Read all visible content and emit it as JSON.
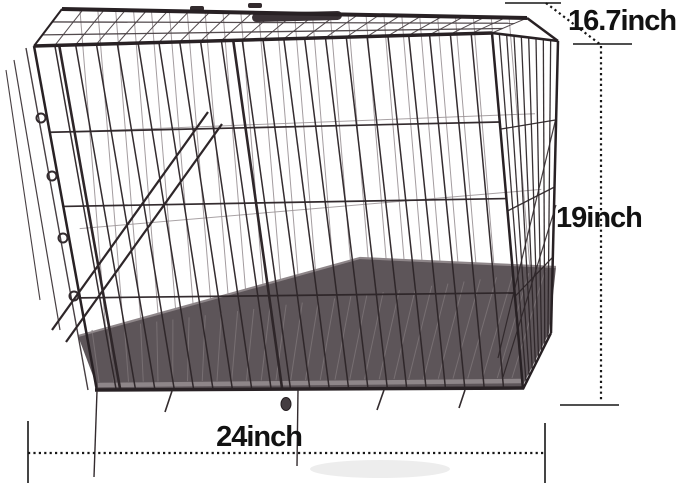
{
  "image": {
    "type": "product-photo",
    "subject": "black folding wire dog crate with removable plastic tray, shown with dimension callouts",
    "background_color": "#ffffff",
    "wire_color": "#2e2629",
    "wire_color_light": "#9a9295",
    "roof_wire_color": "#4a4245",
    "tray_color": "#5d5559",
    "tray_ridge_color": "#7a7275",
    "tray_rim_color": "#8e8689",
    "annotation_color": "#161616"
  },
  "annotations": {
    "depth": {
      "label": "16.7inch"
    },
    "height": {
      "label": "19inch"
    },
    "width": {
      "label": "24inch"
    }
  }
}
